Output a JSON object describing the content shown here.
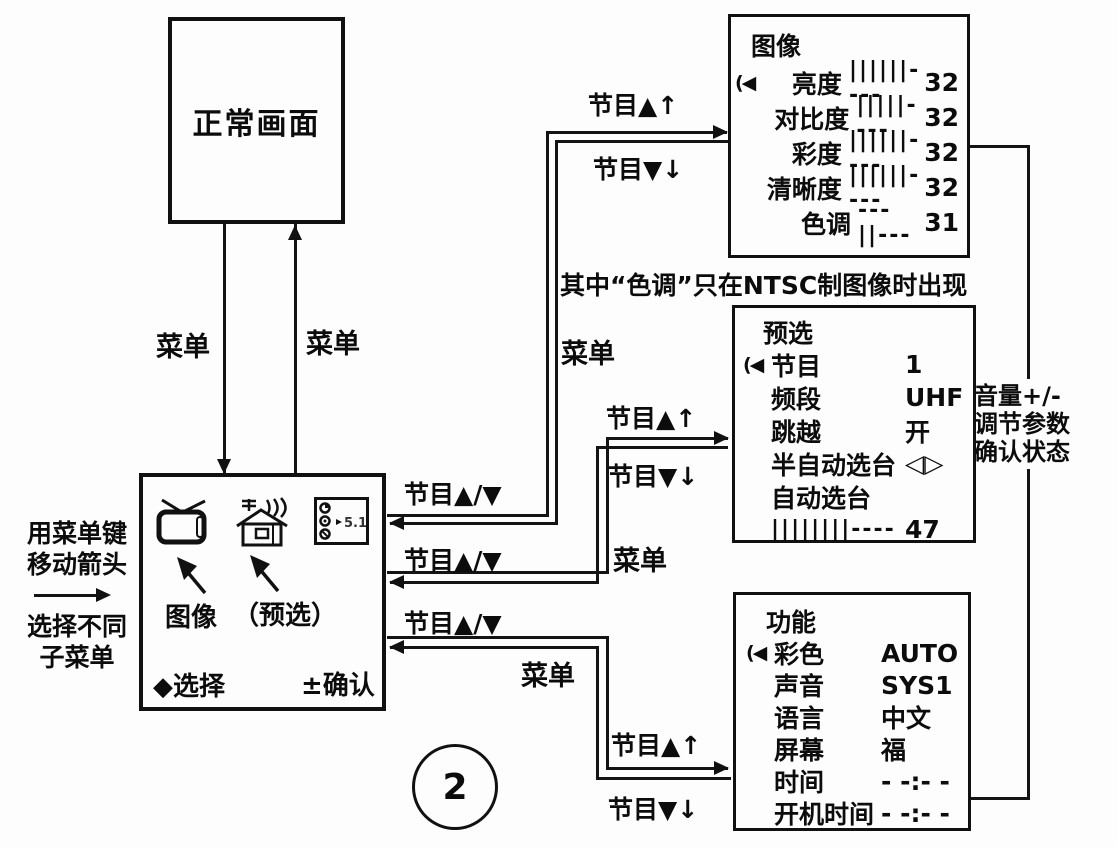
{
  "figure": {
    "number": "2"
  },
  "normal_screen": {
    "label": "正常画面"
  },
  "connector_labels": {
    "menu": "菜单",
    "prog_up": "节目▲↑",
    "prog_down": "节目▼↓",
    "prog_updown": "节目▲/▼"
  },
  "ntsc_note": "其中“色调”只在NTSC制图像时出现",
  "volume_note": {
    "line1": "音量+/-",
    "line2": "调节参数",
    "line3": "确认状态"
  },
  "left_instruction": {
    "line1": "用菜单键",
    "line2": "移动箭头",
    "line3": "选择不同",
    "line4": "子菜单"
  },
  "main_menu": {
    "icons": [
      "tv-icon",
      "house-antenna-icon",
      "control-panel-icon"
    ],
    "panel_text": "5.1",
    "label_picture": "图像",
    "label_preset": "（预选）",
    "select_hint": "◆选择",
    "confirm_hint": "±确认"
  },
  "picture_menu": {
    "title": "图像",
    "rows": [
      {
        "cursor": "(◀",
        "label": "亮度",
        "bar": "||||||----",
        "value": "32"
      },
      {
        "cursor": "",
        "label": "对比度",
        "bar": "|||||----",
        "value": "32"
      },
      {
        "cursor": "",
        "label": "彩度",
        "bar": "||||||----",
        "value": "32"
      },
      {
        "cursor": "",
        "label": "清晰度",
        "bar": "||||||----",
        "value": "32"
      },
      {
        "cursor": "",
        "label": "色调",
        "bar": "---||---",
        "value": "31"
      }
    ]
  },
  "preset_menu": {
    "title": "预选",
    "rows": [
      {
        "cursor": "(◀",
        "label": "节目",
        "value": "1"
      },
      {
        "cursor": "",
        "label": "频段",
        "value": "UHF"
      },
      {
        "cursor": "",
        "label": "跳越",
        "value": "开"
      },
      {
        "cursor": "",
        "label": "半自动选台",
        "value": "◁▷"
      },
      {
        "cursor": "",
        "label": "自动选台",
        "value": ""
      },
      {
        "cursor": "",
        "label": "||||||||----",
        "value": "47"
      }
    ]
  },
  "function_menu": {
    "title": "功能",
    "rows": [
      {
        "cursor": "(◀",
        "label": "彩色",
        "value": "AUTO"
      },
      {
        "cursor": "",
        "label": "声音",
        "value": "SYS1"
      },
      {
        "cursor": "",
        "label": "语言",
        "value": "中文"
      },
      {
        "cursor": "",
        "label": "屏幕",
        "value": "福"
      },
      {
        "cursor": "",
        "label": "时间",
        "value": "- -:- -"
      },
      {
        "cursor": "",
        "label": "开机时间",
        "value": "- -:- -"
      }
    ]
  }
}
